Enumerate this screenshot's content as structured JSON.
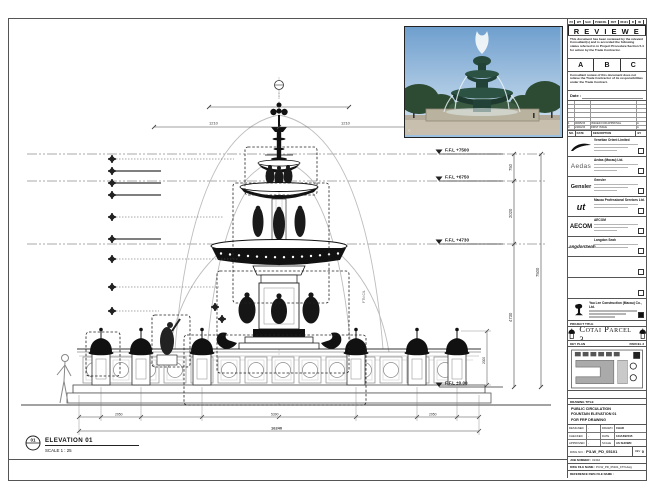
{
  "strip": {
    "segments": [
      "P3",
      "W7",
      "SAC",
      "PUBCRL",
      "FNT",
      "05101",
      "R",
      "00"
    ]
  },
  "stamp": {
    "title": "R E V I E W E D",
    "body1": "This document has been reviewed by the relevant Consultant(s) and is accorded the following status referred to in Project Procedure Section 5.4 for action by the Trade Contractor.",
    "optionA": "A",
    "optionB": "B",
    "optionC": "C",
    "body2": "Consultant review of this document does not relieve the Trade Contractor of its responsibilities under the Trade Contract.",
    "date_label": "Date :"
  },
  "revisions": {
    "rows": [
      {
        "no": "1",
        "date": "06/05/15",
        "desc": "ISSUED FOR APPROVAL",
        "by": "A"
      },
      {
        "no": "0",
        "date": "24/04/15",
        "desc": "FIRST ISSUE",
        "by": "A"
      }
    ],
    "header": {
      "no": "NO.",
      "date": "DATE",
      "desc": "DESCRIPTION",
      "by": "BY"
    }
  },
  "consultants": [
    {
      "logo_text": "",
      "name": "Venetian Orient Limited"
    },
    {
      "logo_text": "Aedas",
      "name": "Aedas (Macau) Ltd."
    },
    {
      "logo_text": "Gensler",
      "name": "Gensler"
    },
    {
      "logo_text": "ut",
      "name": "Macau Professional Services Ltd."
    },
    {
      "logo_text": "AECOM",
      "name": "AECOM"
    },
    {
      "logo_text": "LangdonSeah",
      "name": "Langdon Seah"
    }
  ],
  "contractor": {
    "name": "Yau Lee Construction (Macau) Co., Ltd."
  },
  "project": {
    "band": "PROJECT TITLE",
    "name": "Cotai Parcel 3"
  },
  "key_plan": {
    "band": "KEY PLAN",
    "right": "PARCEL 3"
  },
  "drawing_title": {
    "band": "DRAWING TITLE",
    "line1": "PUBLIC CIRCULATION",
    "line2": "FOUNTAIN ELEVATION 01",
    "line3": "FOR FRP DRAWING"
  },
  "info": {
    "r1c1": "DESIGNED",
    "r1c2": "-",
    "r1c3": "DRAWN",
    "r1c4": "CHAD",
    "r2c1": "CHECKED",
    "r2c2": "-",
    "r2c3": "DATE",
    "r2c4": "12/JUN/2015",
    "r3c1": "APPROVED",
    "r3c2": "-",
    "r3c3": "SCALE",
    "r3c4": "AS SHOWN"
  },
  "dwg": {
    "label": "DWG NO. :",
    "value": "P3-W_PD_05101",
    "rev_label": "REV",
    "rev": "0",
    "job_label": "JOB NUMBER :",
    "job": "31310",
    "file_label": "DWG FILE NAME :",
    "file": "P3-W_PD_05101_FTN.dwg",
    "ref_label": "REFERENCE DWG FILE NAME :"
  },
  "drawing": {
    "levels": {
      "l1": "F.F.L +7500",
      "l2": "F.F.L +6750",
      "l3": "F.F.L +4730",
      "l0": "F.F.L ±0.00"
    },
    "dims": {
      "v1": "750",
      "v2": "2020",
      "v3": "4730",
      "vt": "7500",
      "t1": "1210",
      "t2": "1210",
      "b1": "2950",
      "b2": "5390",
      "b3": "2950",
      "bt": "16240",
      "lamp": "2000"
    },
    "callout": {
      "num": "01",
      "title": "ELEVATION 01",
      "scale": "SCALE 1 : 25"
    },
    "note": "FTN C/L"
  }
}
